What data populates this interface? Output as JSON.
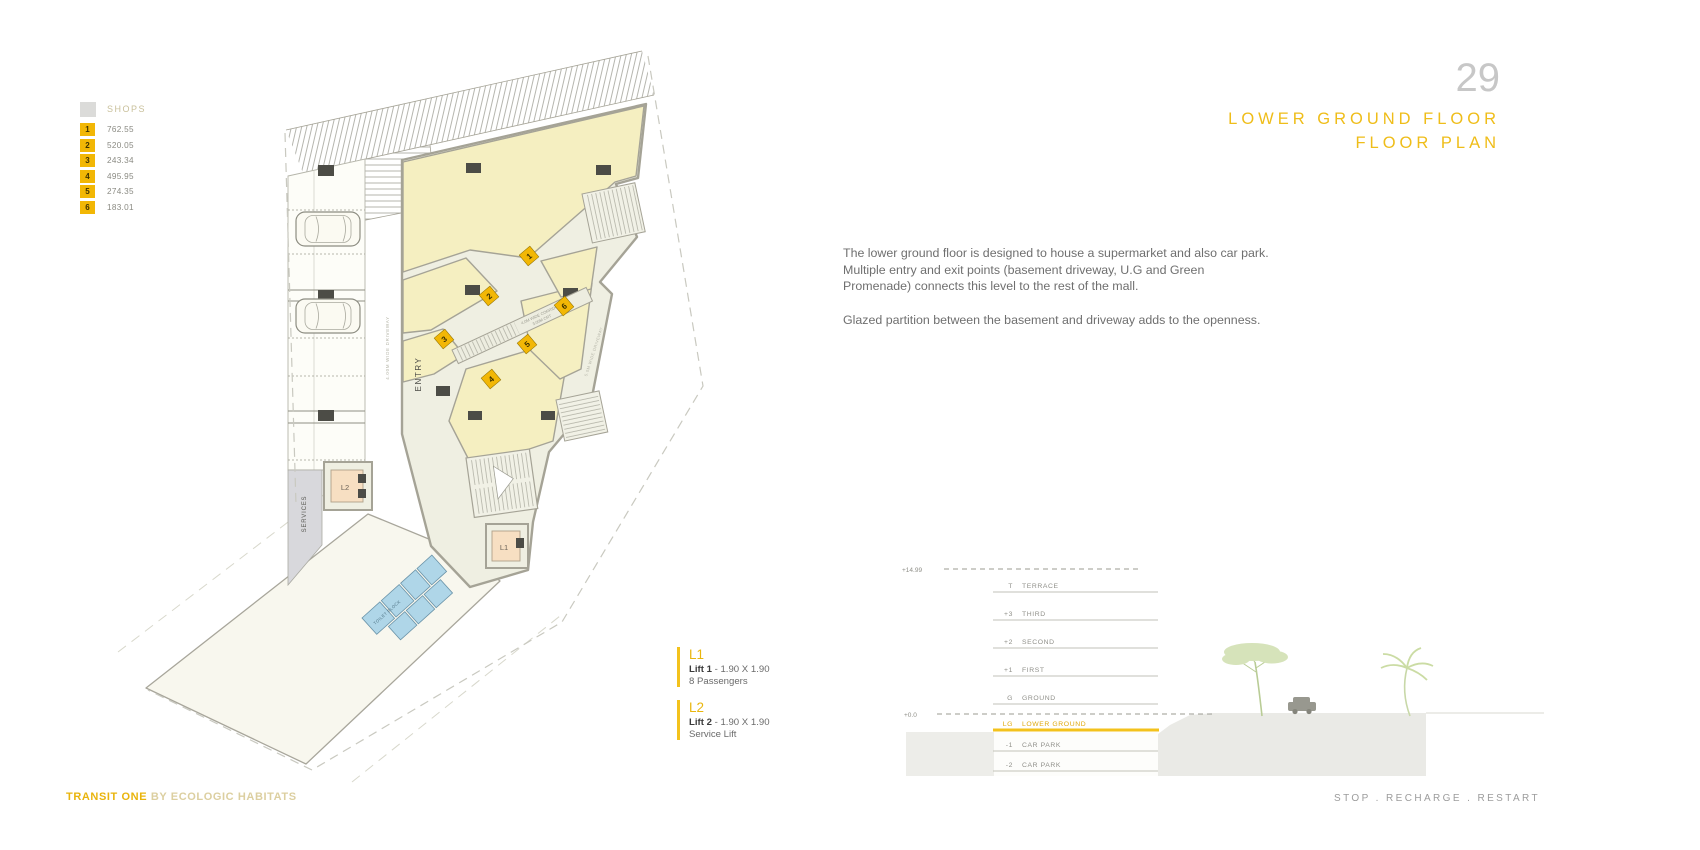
{
  "page": {
    "number": "29",
    "title_line1": "LOWER GROUND FLOOR",
    "title_line2": "FLOOR PLAN"
  },
  "legend": {
    "title": "SHOPS",
    "items": [
      {
        "num": "1",
        "area": "762.55"
      },
      {
        "num": "2",
        "area": "520.05"
      },
      {
        "num": "3",
        "area": "243.34"
      },
      {
        "num": "4",
        "area": "495.95"
      },
      {
        "num": "5",
        "area": "274.35"
      },
      {
        "num": "6",
        "area": "183.01"
      }
    ]
  },
  "description": {
    "para1": "The lower ground floor is designed to house a supermarket and also car park. Multiple entry and exit points (basement driveway, U.G and Green Promenade)  connects this level to the rest of the mall.",
    "para2": "Glazed partition between the basement and driveway adds to the openness."
  },
  "lifts": [
    {
      "id": "L1",
      "name": "Lift 1",
      "size": "- 1.90 X 1.90",
      "detail": "8 Passengers"
    },
    {
      "id": "L2",
      "name": "Lift 2",
      "size": "- 1.90 X 1.90",
      "detail": "Service Lift"
    }
  ],
  "plan": {
    "labels": {
      "entry": "ENTRY",
      "services": "SERVICES",
      "driveway_left": "4.00M WIDE DRIVEWAY",
      "corridor_line1": "4.0M WIDE CORRIDOR",
      "corridor_line2": "3.00M CRT",
      "driveway_right": "5.0M WIDE DRIVEWAY",
      "toilet": "TOILET BLOCK",
      "lift1": "L1",
      "lift2": "L2"
    },
    "shop_numbers": [
      "1",
      "2",
      "3",
      "4",
      "5",
      "6"
    ]
  },
  "section": {
    "top_level": "+14.99",
    "zero_level": "+0.0",
    "floors": [
      {
        "code": "T",
        "name": "TERRACE"
      },
      {
        "code": "+3",
        "name": "THIRD"
      },
      {
        "code": "+2",
        "name": "SECOND"
      },
      {
        "code": "+1",
        "name": "FIRST"
      },
      {
        "code": "G",
        "name": "GROUND"
      },
      {
        "code": "LG",
        "name": "LOWER GROUND"
      },
      {
        "code": "-1",
        "name": "CAR PARK"
      },
      {
        "code": "-2",
        "name": "CAR PARK"
      }
    ]
  },
  "footer": {
    "brand_bold": "TRANSIT ONE",
    "brand_rest": " BY ECOLOGIC HABITATS",
    "right": "STOP  .  RECHARGE  .  RESTART"
  },
  "colors": {
    "accent_gold": "#EFBD19",
    "legend_yellow": "#F2B705",
    "shop_fill": "#F5EFC1",
    "toilet_blue": "#AFD6E8",
    "lift_peach": "#F7DFC2",
    "wall_gray": "#A5A396",
    "section_highlight": "#DFA90E"
  }
}
